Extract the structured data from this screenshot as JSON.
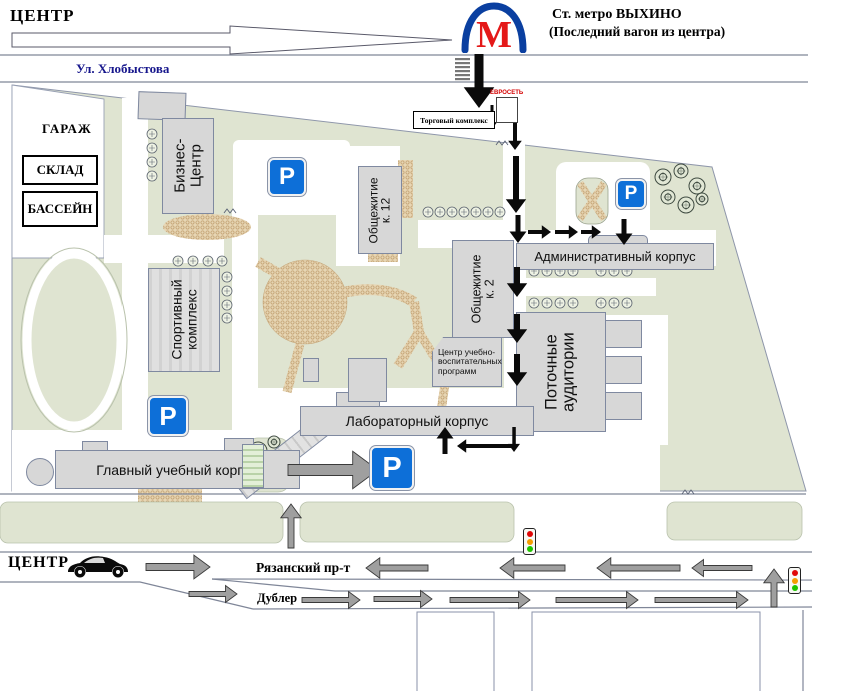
{
  "top": {
    "center": "ЦЕНТР",
    "street": "Ул. Хлобыстова",
    "metro_m": "М",
    "metro_station": "Ст. метро ВЫХИНО",
    "metro_note": "(Последний вагон из центра)"
  },
  "area_labels": {
    "garage": "ГАРАЖ",
    "warehouse": "СКЛАД",
    "pool": "БАССЕЙН",
    "shopping_center": "Торговый комплекс",
    "evroset": "ЕВРОСЕТЬ"
  },
  "buildings": {
    "business_center": "Бизнес-\nЦентр",
    "dorm12": "Общежитие\nк. 12",
    "dorm2": "Общежитие к. 2",
    "sport_complex": "Спортивный\nкомплекс",
    "admin": "Административный корпус",
    "lecture_halls": "Поточные\nаудитории",
    "edu_center": "Центр учебно-\nвоспитательных\nпрограмм",
    "lab": "Лабораторный корпус",
    "main": "Главный учебный корпус"
  },
  "bottom": {
    "center": "ЦЕНТР",
    "avenue": "Рязанский пр-т",
    "service_road": "Дублер"
  },
  "parking_letter": "P",
  "colors": {
    "campus-green": "#dfe4d1",
    "parking-blue": "#0d6fd8",
    "metro-blue": "#0a3fa0",
    "metro-red": "#e41818",
    "street-blue": "#16168c",
    "sand": "#e7d6b4"
  }
}
